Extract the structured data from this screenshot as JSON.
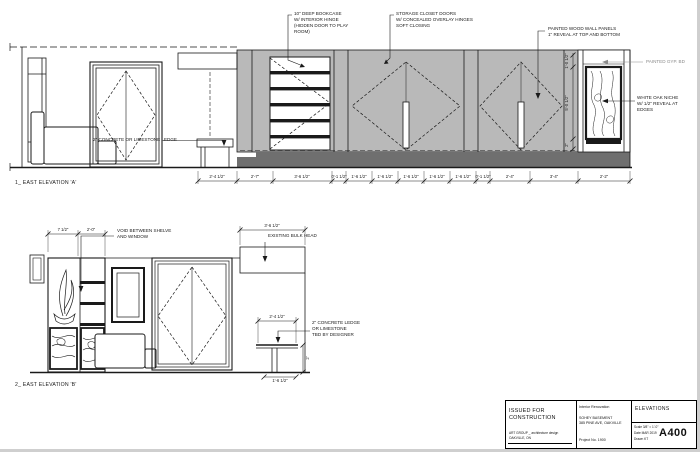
{
  "colors": {
    "wall_panel_gray": "#b9b9b9",
    "base_band_gray": "#6f6f6f",
    "gyp_text_gray": "#8a8a8a"
  },
  "elev_a": {
    "label": "1_ EAST ELEVATION 'A'",
    "annotations": {
      "bookcase": "10\" DEEP BOOKCASE\nW/ INTERIOR HINGE\n(HIDDEN DOOR TO PLAY\nROOM)",
      "storage": "STORAGE CLOSET DOORS\nW/ CONCEALED OVERLAY HINGES\nSOFT CLOSING",
      "wood_panels": "PAINTED WOOD WALL PANELS\n1\" REVEAL AT TOP AND BOTTOM",
      "gyp_bd": "PAINTED GYP. BD",
      "oak_niche": "WHITE OAK NICHE\nW/ 1/2\" REVEAL AT\nEDGES",
      "ledge": "2\" CONCRETE OR LIMESTONE LEDGE"
    },
    "dims": [
      "2'-4 1/2\"",
      "2'-7\"",
      "3'-6 1/2\"",
      "0'-1 1/2\"",
      "1'-6 1/2\"",
      "1'-6 1/2\"",
      "1'-6 1/2\"",
      "1'-6 1/2\"",
      "1'-6 1/2\"",
      "0'-1 1/2\"",
      "2'-4\"",
      "3'-4\"",
      "2'-2\""
    ],
    "vdims": [
      "1'-0 1/2\"",
      "5'-0 1/2\"",
      "2\""
    ]
  },
  "elev_b": {
    "label": "2_ EAST ELEVATION 'B'",
    "annotations": {
      "void": "VOID BETWEEN SHELVE\nAND WINDOW",
      "bulkhead": "EXISTING BULK HEAD",
      "ledge": "2\" CONCRETE LEDGE\nOR LIMESTONE\nTBD BY DESIGNER"
    },
    "dims": {
      "top_left_1": "7 1/2\"",
      "top_left_2": "2'-0\"",
      "bulkhead": "3'-6 1/2\"",
      "ledge_top": "2'-4 1/2\"",
      "ledge_bottom": "1'-6 1/2\"",
      "right_vert": "2'"
    }
  },
  "titleblock": {
    "issued": "ISSUED FOR CONSTRUCTION",
    "fine_print": "ART GROUP _ architecture design\nOAKVILLE, ON",
    "project_type": "Interior Renovation",
    "project_name": "SOHEY BASEMENT\n385 PINE AVE, OAKVILLE",
    "project_no": "Project No. 1900",
    "sheet_title": "ELEVATIONS",
    "scale": "Scale   3/8\" = 1'-0\"",
    "date": "Date    MAR 2019",
    "drawn": "Drawn  KT",
    "sheet_no": "A400"
  }
}
